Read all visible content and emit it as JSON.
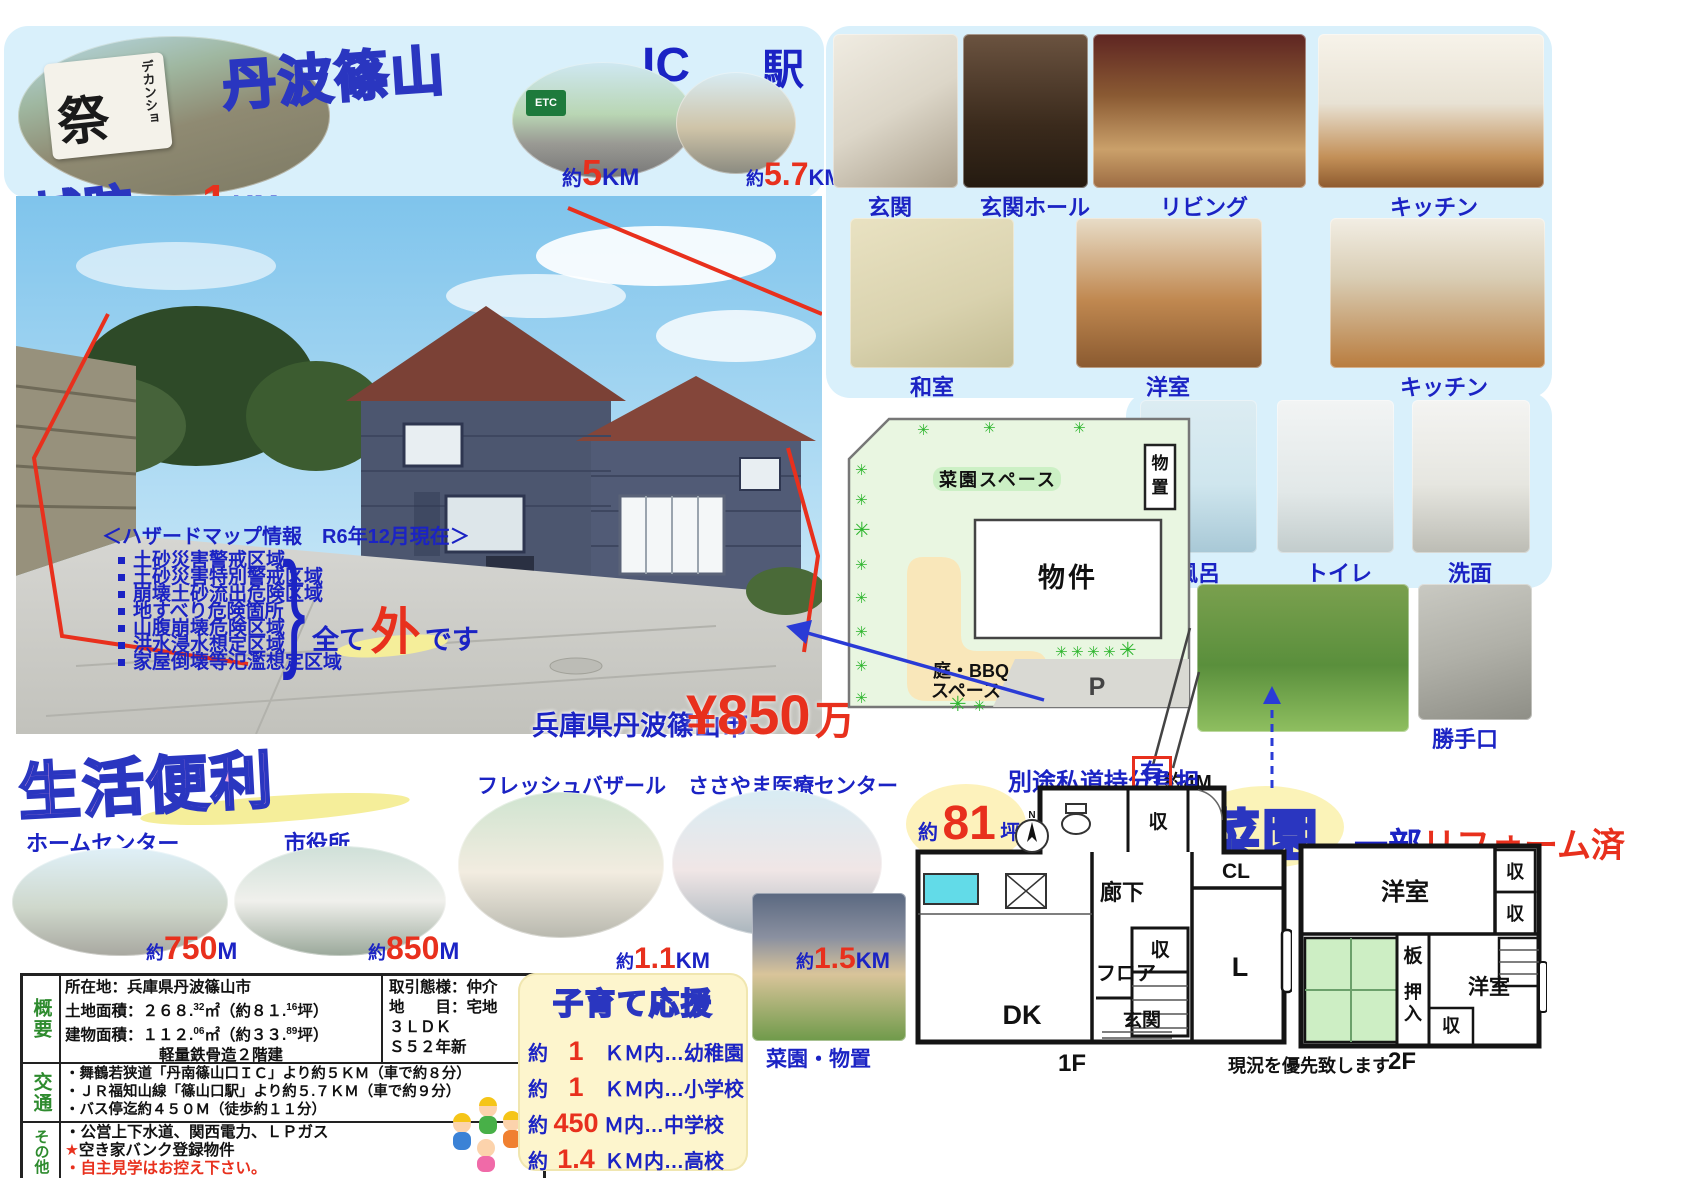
{
  "top": {
    "area_bubble": "丹波篠山",
    "banner_small": "デカンショ",
    "banner_big": "祭",
    "castle": {
      "bubble": "城跡",
      "prefix": "へ約",
      "value": "1",
      "unit": "KM"
    },
    "ic": {
      "title": "IC",
      "sign": "ETC",
      "prefix": "約",
      "value": "5",
      "unit": "KM"
    },
    "station": {
      "title": "駅",
      "prefix": "約",
      "value": "5.7",
      "unit": "KM"
    }
  },
  "hazard": {
    "title": "＜ハザードマップ情報　R6年12月現在＞",
    "items": [
      "土砂災害警戒区域",
      "土砂災害特別警戒区域",
      "崩壊土砂流出危険区域",
      "地すべり危険箇所",
      "山腹崩壊危険区域",
      "洪水浸水想定区域",
      "家屋倒壊等氾濫想定区域"
    ],
    "brace": "}",
    "result_prefix": "全て",
    "result_emphasis": "外",
    "result_suffix": "です"
  },
  "price": {
    "city": "兵庫県丹波篠山市",
    "amount": "¥850",
    "unit": "万"
  },
  "life": {
    "bubble": "生活便利",
    "facilities": [
      {
        "name": "ホームセンター",
        "prefix": "約",
        "value": "750",
        "unit": "M"
      },
      {
        "name": "市役所",
        "prefix": "約",
        "value": "850",
        "unit": "M"
      },
      {
        "name": "フレッシュバザール",
        "prefix": "約",
        "value": "1.1",
        "unit": "KM"
      },
      {
        "name": "ささやま医療センター",
        "prefix": "約",
        "value": "1.5",
        "unit": "KM"
      }
    ]
  },
  "gallery": {
    "row1": [
      "玄関",
      "玄関ホール",
      "リビング",
      "キッチン"
    ],
    "row2": [
      "和室",
      "洋室",
      "キッチン"
    ],
    "row3": [
      "風呂",
      "トイレ",
      "洗面"
    ],
    "back_door": "勝手口",
    "garden_shed": "菜園・物置"
  },
  "site_plan": {
    "garden": "菜園スペース",
    "shed_1": "物",
    "shed_2": "置",
    "building": "物件",
    "bbq_line1": "庭・BBQ",
    "bbq_line2": "スペース",
    "parking": "P",
    "tree": "✳",
    "road_width": "約4M",
    "private_road_label": "別途私道持分負担",
    "private_road_value": "有"
  },
  "badges": {
    "area_prefix": "約",
    "area_value": "81",
    "area_unit": "坪",
    "saien": "菜園",
    "reform_prefix": "一部",
    "reform_text": "リフォーム済"
  },
  "spec_table": {
    "overview_header": "概要",
    "location": "所在地：兵庫県丹波篠山市",
    "land": {
      "p1": "土地面積：２６８.",
      "s1": "32",
      "p2": "㎡（約８１.",
      "s2": "16",
      "p3": "坪）"
    },
    "building": {
      "p1": "建物面積：１１２.",
      "s1": "06",
      "p2": "㎡（約３３.",
      "s2": "89",
      "p3": "坪）"
    },
    "structure": "軽量鉄骨造２階建",
    "deal": "取引態様：仲介",
    "land_use": "地　　目：宅地",
    "layout": "３ＬＤＫ",
    "built": "Ｓ５２年新",
    "transport_header": "交通",
    "transport": [
      "・舞鶴若狭道「丹南篠山口ＩＣ」より約５ＫＭ（車で約８分）",
      "・ＪＲ福知山線「篠山口駅」より約５.７ＫＭ（車で約９分）",
      "・バス停迄約４５０Ｍ（徒歩約１１分）"
    ],
    "other_header": "その他",
    "other_line1": "・公営上下水道、関西電力、ＬＰガス",
    "other_star": "★",
    "other_line2": "空き家バンク登録物件",
    "other_line3": "・自主見学はお控え下さい。"
  },
  "kosodate": {
    "title": "子育て応援",
    "items": [
      {
        "prefix": "約",
        "value": "1",
        "suffix": "ＫＭ内…幼稚園"
      },
      {
        "prefix": "約",
        "value": "1",
        "suffix": "ＫＭ内…小学校"
      },
      {
        "prefix": "約",
        "value": "450",
        "suffix": "Ｍ内…中学校"
      },
      {
        "prefix": "約",
        "value": "1.4",
        "suffix": "ＫＭ内…高校"
      }
    ]
  },
  "floor_plan": {
    "compass": "N",
    "f1": {
      "label": "1F",
      "rouka": "廊下",
      "cl": "CL",
      "shu_top": "収",
      "shu_mid": "収",
      "dk": "DK",
      "floor": "フロア",
      "genkan": "玄関",
      "living": "L"
    },
    "f2": {
      "label": "2F",
      "yoshitsu_top": "洋室",
      "shu1": "収",
      "shu2": "収",
      "ita": "板",
      "oshiire_1": "押",
      "oshiire_2": "入",
      "yoshitsu_btm": "洋室",
      "shu3": "収"
    },
    "note": "現況を優先致します"
  }
}
